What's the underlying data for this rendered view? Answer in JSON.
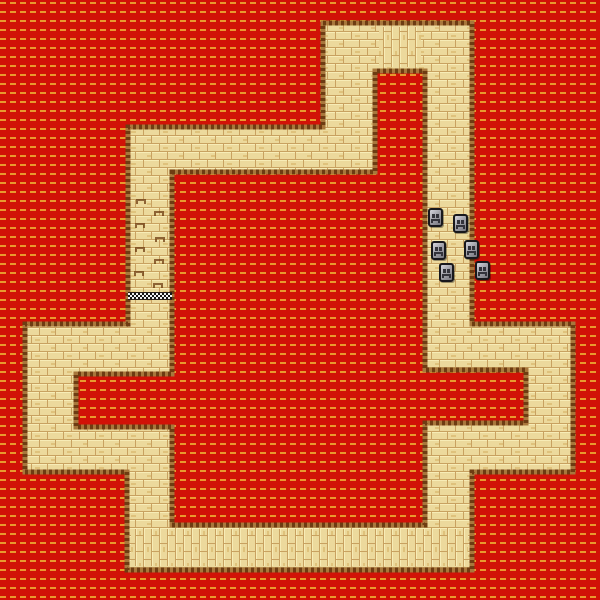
{
  "colors": {
    "lava_red": "#d11207",
    "lava_dash": "#e89a2e",
    "brick_fill": "#ecd99c",
    "brick_mortar": "#c8a160",
    "brick_hi": "#f7ecb6",
    "brick_spk": "#dfc27c",
    "edge_dark": "#6e3c12",
    "edge_light": "#a8773c",
    "stone_body": "#a2a2aa",
    "stone_light": "#d6d6de",
    "stone_dark": "#76767e",
    "stone_outline": "#18181c",
    "stone_face": "#33333b",
    "checker_dark": "#161616",
    "checker_light": "#f2f2f2"
  },
  "track": {
    "outer": [
      [
        323,
        23
      ],
      [
        472,
        23
      ],
      [
        472,
        324
      ],
      [
        573,
        324
      ],
      [
        573,
        472
      ],
      [
        472,
        472
      ],
      [
        472,
        570
      ],
      [
        127,
        570
      ],
      [
        127,
        472
      ],
      [
        25,
        472
      ],
      [
        25,
        324
      ],
      [
        128,
        324
      ],
      [
        128,
        127
      ],
      [
        323,
        127
      ]
    ],
    "inner": [
      [
        172,
        172
      ],
      [
        375,
        172
      ],
      [
        375,
        71
      ],
      [
        425,
        71
      ],
      [
        425,
        370
      ],
      [
        526,
        370
      ],
      [
        526,
        423
      ],
      [
        425,
        423
      ],
      [
        425,
        525
      ],
      [
        172,
        525
      ],
      [
        172,
        427
      ],
      [
        76,
        427
      ],
      [
        76,
        374
      ],
      [
        172,
        374
      ]
    ],
    "vertical_brick_patches": [
      [
        131,
        529,
        337,
        37
      ],
      [
        379,
        27,
        42,
        40
      ]
    ],
    "edge_width": 5
  },
  "finish_line": {
    "x": 128,
    "y": 292,
    "w": 44,
    "h": 8
  },
  "crack_marks": [
    [
      136,
      199
    ],
    [
      154,
      211
    ],
    [
      135,
      223
    ],
    [
      155,
      237
    ],
    [
      135,
      247
    ],
    [
      154,
      259
    ],
    [
      134,
      271
    ],
    [
      153,
      283
    ]
  ],
  "stones": [
    [
      428,
      208
    ],
    [
      453,
      214
    ],
    [
      431,
      241
    ],
    [
      464,
      240
    ],
    [
      439,
      263
    ],
    [
      475,
      261
    ]
  ],
  "stone_size": {
    "w": 15,
    "h": 19
  }
}
